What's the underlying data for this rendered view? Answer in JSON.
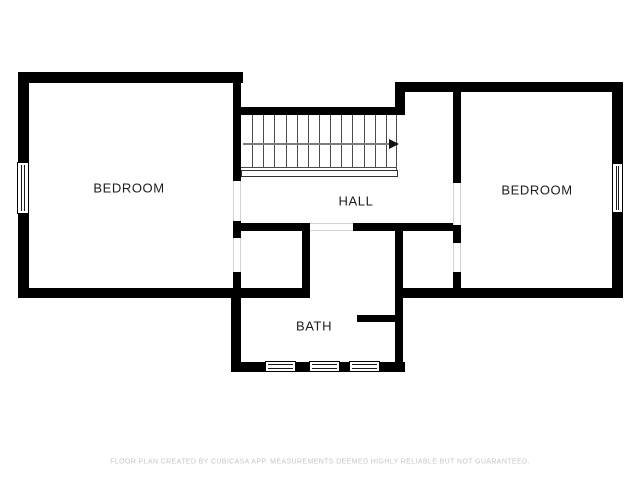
{
  "rooms": {
    "bedroom_left": {
      "label": "BEDROOM"
    },
    "hall": {
      "label": "HALL"
    },
    "bath": {
      "label": "BATH"
    },
    "bedroom_right": {
      "label": "BEDROOM"
    }
  },
  "stairs": {
    "tread_count": 13,
    "direction_arrow": "right"
  },
  "footer": {
    "disclaimer": "FLOOR PLAN CREATED BY CUBICASA APP. MEASUREMENTS DEEMED HIGHLY RELIABLE BUT NOT GUARANTEED."
  },
  "colors": {
    "wall": "#000000",
    "stair_line": "#4a4a4a",
    "arrow_line": "#7d7d7d",
    "door_guide": "#d4d4d4",
    "label_text": "#1c1c1c",
    "footer_text": "#c6c6c6",
    "background": "#ffffff"
  }
}
